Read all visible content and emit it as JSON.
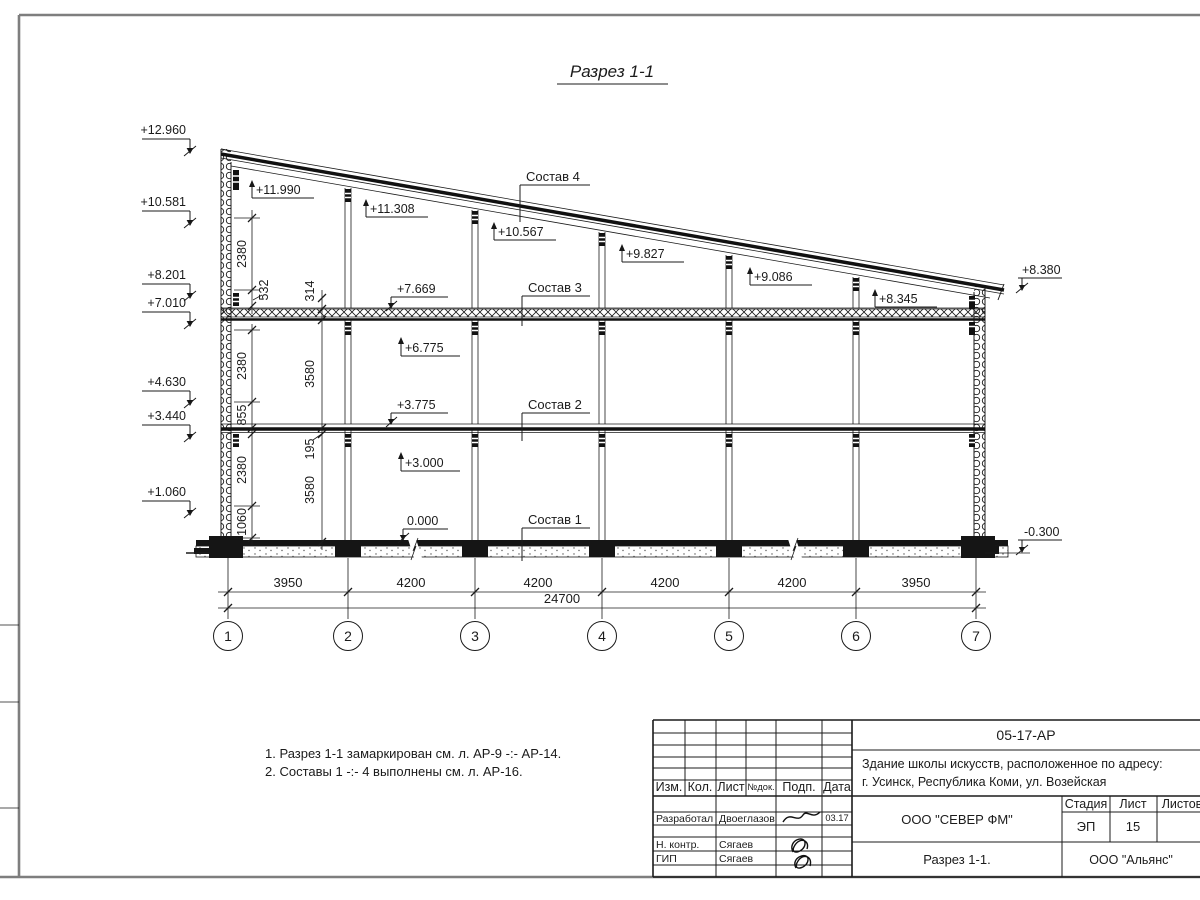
{
  "sheet": {
    "title": "Разрез 1-1",
    "notes": [
      "1. Разрез 1-1 замаркирован см. л. АР-9 -:- АР-14.",
      "2. Составы 1 -:- 4 выполнены см. л. АР-16."
    ]
  },
  "drawing": {
    "left_marks": [
      "+12.960",
      "+10.581",
      "+8.201",
      "+7.010",
      "+4.630",
      "+3.440",
      "+1.060"
    ],
    "roof_marks": [
      "+11.990",
      "+11.308",
      "+10.567",
      "+9.827",
      "+9.086",
      "+8.345"
    ],
    "floor_marks": [
      "+7.669",
      "+6.775",
      "+3.775",
      "+3.000",
      "0.000"
    ],
    "right_mark": "+8.380",
    "ground_right_mark": "-0.300",
    "sostav_labels": [
      "Состав 4",
      "Состав 3",
      "Состав 2",
      "Состав 1"
    ],
    "vdims_a": [
      "2380",
      "532",
      "2380",
      "855",
      "2380",
      "1060"
    ],
    "vdims_b": [
      "314",
      "3580",
      "195",
      "3580"
    ],
    "hdims": [
      "3950",
      "4200",
      "4200",
      "4200",
      "4200",
      "3950"
    ],
    "total_dim": "24700",
    "axes": [
      "1",
      "2",
      "3",
      "4",
      "5",
      "6",
      "7"
    ]
  },
  "titleblock": {
    "doc_number": "05-17-АР",
    "project_line1": "Здание школы искусств, расположенное по адресу:",
    "project_line2": "г. Усинск, Республика Коми, ул. Возейская",
    "header_cells": [
      "Изм.",
      "Кол.",
      "Лист",
      "№док.",
      "Подп.",
      "Дата"
    ],
    "rows": [
      {
        "role": "Разработал",
        "name": "Двоеглазов",
        "date": "03.17"
      },
      {
        "role": "Н. контр.",
        "name": "Сягаев"
      },
      {
        "role": "ГИП",
        "name": "Сягаев"
      }
    ],
    "company": "ООО \"СЕВЕР ФМ\"",
    "sheet_title": "Разрез 1-1.",
    "contractor": "ООО \"Альянс\"",
    "stage_label": "Стадия",
    "sheet_label": "Лист",
    "sheets_label": "Листов",
    "stage_value": "ЭП",
    "sheet_value": "15"
  }
}
